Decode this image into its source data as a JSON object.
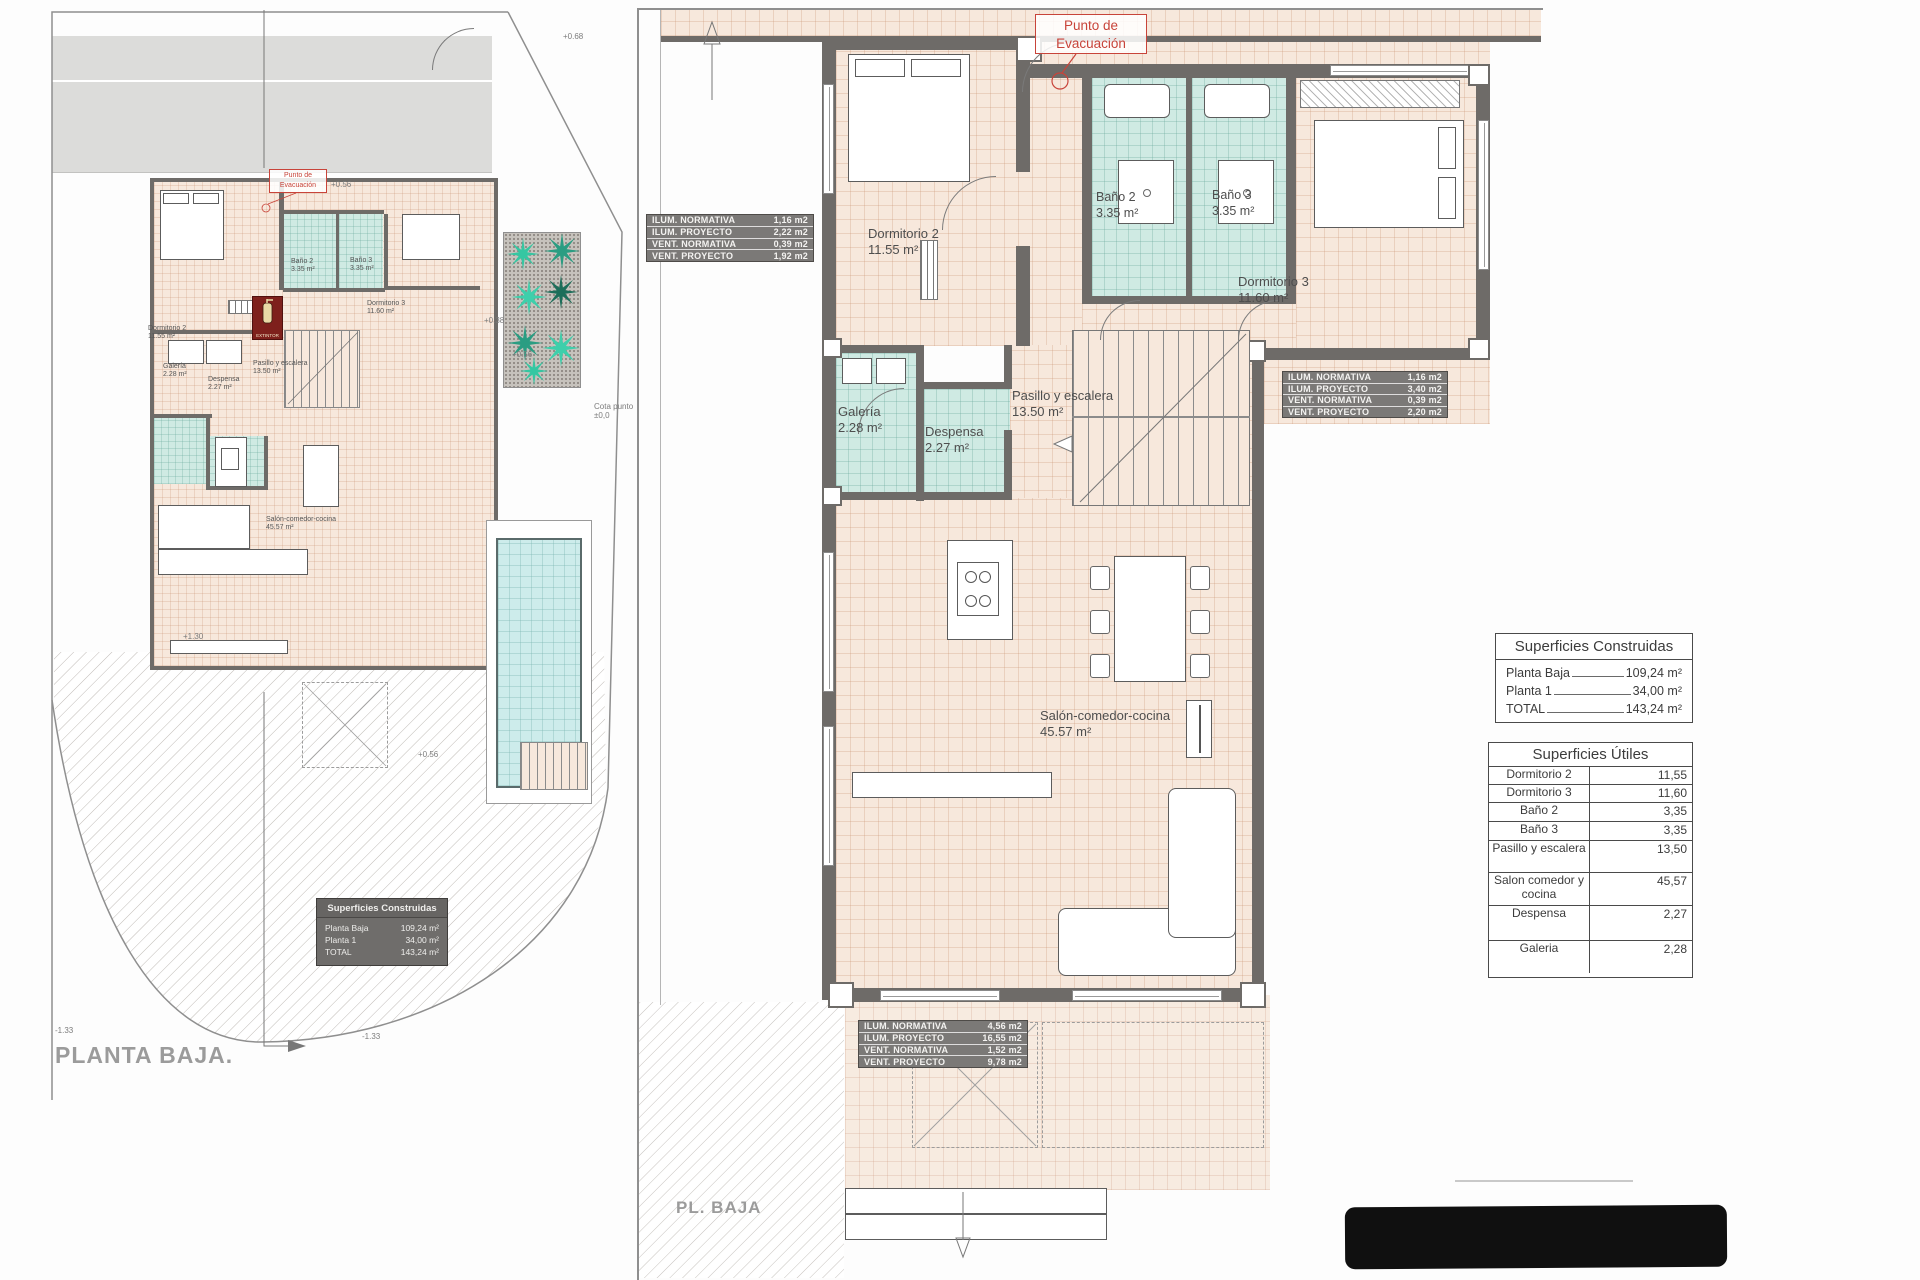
{
  "rooms": {
    "dormitorio2": {
      "name": "Dormitorio 2",
      "area": "11.55 m²"
    },
    "dormitorio3": {
      "name": "Dormitorio 3",
      "area": "11.60 m²"
    },
    "bano2": {
      "name": "Baño 2",
      "area": "3.35 m²"
    },
    "bano3": {
      "name": "Baño 3",
      "area": "3.35 m²"
    },
    "galeria": {
      "name": "Galería",
      "area": "2.28 m²"
    },
    "despensa": {
      "name": "Despensa",
      "area": "2.27 m²"
    },
    "pasillo": {
      "name": "Pasillo y escalera",
      "area": "13.50 m²"
    },
    "salon": {
      "name": "Salón-comedor-cocina",
      "area": "45.57 m²"
    }
  },
  "annotations": {
    "evacuation": "Punto de Evacuación",
    "extintor": "EXTINTOR",
    "left_title": "PLANTA BAJA.",
    "right_title": "PL. BAJA",
    "cota_note": "Cota punto",
    "cota_value": "±0,0",
    "elevations": [
      "+0.68",
      "+0.38",
      "+0.56",
      "+0.56",
      "+0.56",
      "+1.30",
      "-1.33",
      "-1.33"
    ]
  },
  "ilum_tables": {
    "labels": [
      "ILUM. NORMATIVA",
      "ILUM. PROYECTO",
      "VENT. NORMATIVA",
      "VENT. PROYECTO"
    ],
    "table1": [
      "1,16 m2",
      "2,22 m2",
      "0,39 m2",
      "1,92 m2"
    ],
    "table2": [
      "1,16 m2",
      "3,40 m2",
      "0,39 m2",
      "2,20 m2"
    ],
    "table3": [
      "4,56 m2",
      "16,55 m2",
      "1,52 m2",
      "9,78 m2"
    ]
  },
  "superficies_construidas": {
    "title": "Superficies Construidas",
    "rows": [
      {
        "label": "Planta Baja",
        "value": "109,24 m²"
      },
      {
        "label": "Planta 1",
        "value": "34,00 m²"
      },
      {
        "label": "TOTAL",
        "value": "143,24 m²"
      }
    ]
  },
  "superficies_utiles": {
    "title": "Superficies Útiles",
    "rows": [
      {
        "label": "Dormitorio 2",
        "value": "11,55"
      },
      {
        "label": "Dormitorio 3",
        "value": "11,60"
      },
      {
        "label": "Baño 2",
        "value": "3,35"
      },
      {
        "label": "Baño 3",
        "value": "3,35"
      },
      {
        "label": "Pasillo y escalera",
        "value": "13,50"
      },
      {
        "label": "Salon comedor y cocina",
        "value": "45,57"
      },
      {
        "label": "Despensa",
        "value": "2,27"
      },
      {
        "label": "Galeria",
        "value": "2,28"
      }
    ]
  },
  "colors": {
    "wall": "#6e6b68",
    "floor": "#f7e8dc",
    "wet": "#cfeae3",
    "pool": "#cdeceb",
    "palm": "#3ecfab",
    "red": "#c8443a",
    "tbl": "#7b7977",
    "graylbl": "#9b9b9b"
  }
}
